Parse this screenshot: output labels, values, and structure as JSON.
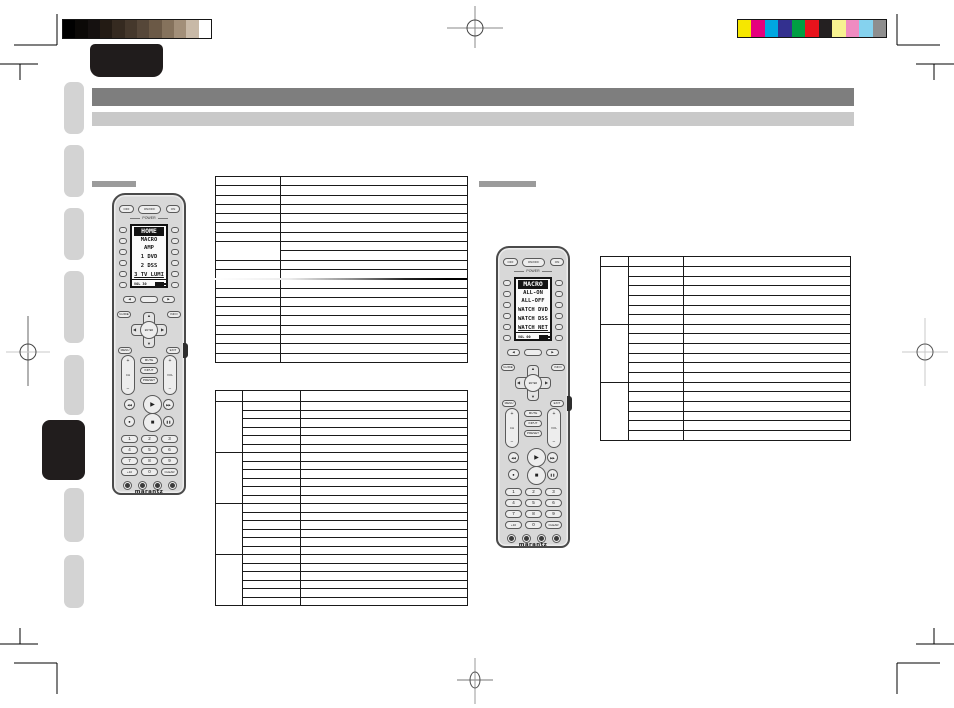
{
  "print_marks": {
    "grayscale_bar": [
      "#000000",
      "#0b0907",
      "#151110",
      "#231b14",
      "#352a20",
      "#45382c",
      "#564739",
      "#6b5946",
      "#85725c",
      "#a28f79",
      "#c8b9a7",
      "#ffffff"
    ],
    "color_bar": [
      "#f6e700",
      "#e6007d",
      "#00a7e1",
      "#33308f",
      "#009e43",
      "#e8131c",
      "#242021",
      "#f7f291",
      "#ef8bc1",
      "#85d2ee",
      "#8e8e8e"
    ]
  },
  "sidebar": {
    "tab_count": 8,
    "active_index": 5
  },
  "remotes": {
    "left": {
      "power_buttons": [
        "OFF",
        "ON/OFF",
        "ON"
      ],
      "power_label": "POWER",
      "lcd": {
        "title": "HOME",
        "items": [
          "MACRO",
          "AMP",
          "1 DVD",
          "2 DSS",
          "3 TV LUMI"
        ],
        "status": "VOL 30"
      },
      "page_buttons": {
        "left": "◀",
        "center": "",
        "right": "▶"
      },
      "function_buttons": {
        "guide": "GUIDE",
        "info": "INFO",
        "menu": "MENU",
        "exit": "EXIT",
        "enter": "ENTER"
      },
      "rockers": {
        "left_top": "+",
        "left_label": "CH",
        "left_bottom": "−",
        "right_top": "+",
        "right_label": "VOL",
        "right_bottom": "−"
      },
      "center_buttons": [
        "MUTE",
        "INPUT",
        "PRESET"
      ],
      "transport_icons": [
        "rewind-icon",
        "play-icon",
        "fast-forward-icon",
        "record-icon",
        "stop-icon",
        "pause-icon"
      ],
      "numpad": [
        "1",
        "2",
        "3",
        "4",
        "5",
        "6",
        "7",
        "8",
        "9",
        "+10",
        "0",
        "CLEAR"
      ],
      "brand": "marantz"
    },
    "right": {
      "power_buttons": [
        "OFF",
        "ON/OFF",
        "ON"
      ],
      "power_label": "POWER",
      "lcd": {
        "title": "MACRO",
        "items": [
          "ALL-ON",
          "ALL-OFF",
          "WATCH DVD",
          "WATCH DSS",
          "WATCH NET"
        ],
        "status": "VOL 00"
      },
      "page_buttons": {
        "left": "◀",
        "center": "",
        "right": "▶"
      },
      "function_buttons": {
        "guide": "GUIDE",
        "info": "INFO",
        "menu": "MENU",
        "exit": "EXIT",
        "enter": "ENTER"
      },
      "rockers": {
        "left_top": "+",
        "left_label": "CH",
        "left_bottom": "−",
        "right_top": "+",
        "right_label": "VOL",
        "right_bottom": "−"
      },
      "center_buttons": [
        "MUTE",
        "INPUT",
        "PRESET"
      ],
      "transport_icons": [
        "rewind-icon",
        "play-icon",
        "fast-forward-icon",
        "record-icon",
        "stop-icon",
        "pause-icon"
      ],
      "numpad": [
        "1",
        "2",
        "3",
        "4",
        "5",
        "6",
        "7",
        "8",
        "9",
        "+10",
        "0",
        "CLEAR"
      ],
      "brand": "marantz"
    }
  },
  "tables": {
    "top_left": {
      "columns": 2,
      "rows": 20,
      "merged_row": 7,
      "merged_span": 2,
      "cells": "empty"
    },
    "bottom_left": {
      "columns": 3,
      "header": true,
      "groups": 4,
      "rows_per_group": 6,
      "cells": "empty"
    },
    "right": {
      "columns": 3,
      "header": true,
      "groups": 3,
      "rows_per_group": 6,
      "cells": "empty"
    }
  }
}
